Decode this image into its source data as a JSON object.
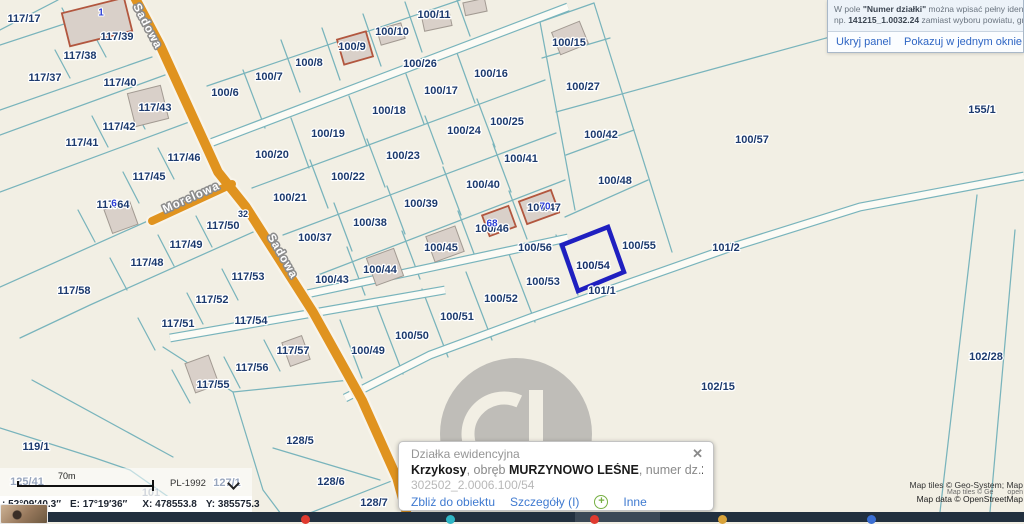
{
  "map": {
    "bg_color": "#f2efe4",
    "line_color": "#79b4bc",
    "road_color": "#e0931f",
    "label_color": "#1c3a6e",
    "highlight_color": "#1f1fc0",
    "parcel_labels": [
      {
        "t": "117/17",
        "x": 24,
        "y": 18
      },
      {
        "t": "117/39",
        "x": 117,
        "y": 36
      },
      {
        "t": "117/38",
        "x": 80,
        "y": 55
      },
      {
        "t": "117/37",
        "x": 45,
        "y": 77
      },
      {
        "t": "117/40",
        "x": 120,
        "y": 82
      },
      {
        "t": "117/43",
        "x": 155,
        "y": 107
      },
      {
        "t": "117/42",
        "x": 119,
        "y": 126
      },
      {
        "t": "117/41",
        "x": 82,
        "y": 142
      },
      {
        "t": "117/46",
        "x": 184,
        "y": 157
      },
      {
        "t": "117/45",
        "x": 149,
        "y": 176
      },
      {
        "t": "117/64",
        "x": 113,
        "y": 204
      },
      {
        "t": "117/50",
        "x": 223,
        "y": 225
      },
      {
        "t": "117/49",
        "x": 186,
        "y": 244
      },
      {
        "t": "117/48",
        "x": 147,
        "y": 262
      },
      {
        "t": "117/58",
        "x": 74,
        "y": 290
      },
      {
        "t": "117/53",
        "x": 248,
        "y": 276
      },
      {
        "t": "117/52",
        "x": 212,
        "y": 299
      },
      {
        "t": "117/51",
        "x": 178,
        "y": 323
      },
      {
        "t": "117/54",
        "x": 251,
        "y": 320
      },
      {
        "t": "117/57",
        "x": 293,
        "y": 350
      },
      {
        "t": "117/56",
        "x": 252,
        "y": 367
      },
      {
        "t": "117/55",
        "x": 213,
        "y": 384
      },
      {
        "t": "100/6",
        "x": 225,
        "y": 92
      },
      {
        "t": "100/7",
        "x": 269,
        "y": 76
      },
      {
        "t": "100/8",
        "x": 309,
        "y": 62
      },
      {
        "t": "100/9",
        "x": 352,
        "y": 46
      },
      {
        "t": "100/10",
        "x": 392,
        "y": 31
      },
      {
        "t": "100/11",
        "x": 434,
        "y": 14
      },
      {
        "t": "100/26",
        "x": 420,
        "y": 63
      },
      {
        "t": "100/15",
        "x": 569,
        "y": 42
      },
      {
        "t": "100/16",
        "x": 491,
        "y": 73
      },
      {
        "t": "100/17",
        "x": 441,
        "y": 90
      },
      {
        "t": "100/18",
        "x": 389,
        "y": 110
      },
      {
        "t": "100/19",
        "x": 328,
        "y": 133
      },
      {
        "t": "100/20",
        "x": 272,
        "y": 154
      },
      {
        "t": "100/27",
        "x": 583,
        "y": 86
      },
      {
        "t": "100/25",
        "x": 507,
        "y": 121
      },
      {
        "t": "100/24",
        "x": 464,
        "y": 130
      },
      {
        "t": "100/23",
        "x": 403,
        "y": 155
      },
      {
        "t": "100/22",
        "x": 348,
        "y": 176
      },
      {
        "t": "100/21",
        "x": 290,
        "y": 197
      },
      {
        "t": "100/42",
        "x": 601,
        "y": 134
      },
      {
        "t": "100/41",
        "x": 521,
        "y": 158
      },
      {
        "t": "100/40",
        "x": 483,
        "y": 184
      },
      {
        "t": "100/39",
        "x": 421,
        "y": 203
      },
      {
        "t": "100/38",
        "x": 370,
        "y": 222
      },
      {
        "t": "100/37",
        "x": 315,
        "y": 237
      },
      {
        "t": "100/48",
        "x": 615,
        "y": 180
      },
      {
        "t": "100/47",
        "x": 544,
        "y": 207
      },
      {
        "t": "100/46",
        "x": 492,
        "y": 228
      },
      {
        "t": "100/45",
        "x": 441,
        "y": 247
      },
      {
        "t": "100/44",
        "x": 380,
        "y": 269
      },
      {
        "t": "100/43",
        "x": 332,
        "y": 279
      },
      {
        "t": "100/57",
        "x": 752,
        "y": 139
      },
      {
        "t": "100/56",
        "x": 535,
        "y": 247
      },
      {
        "t": "100/55",
        "x": 639,
        "y": 245
      },
      {
        "t": "100/53",
        "x": 543,
        "y": 281
      },
      {
        "t": "100/52",
        "x": 501,
        "y": 298
      },
      {
        "t": "100/51",
        "x": 457,
        "y": 316
      },
      {
        "t": "100/50",
        "x": 412,
        "y": 335
      },
      {
        "t": "100/49",
        "x": 368,
        "y": 350
      },
      {
        "t": "101/2",
        "x": 726,
        "y": 247
      },
      {
        "t": "101/1",
        "x": 602,
        "y": 290
      },
      {
        "t": "155/1",
        "x": 982,
        "y": 109
      },
      {
        "t": "102/28",
        "x": 986,
        "y": 356
      },
      {
        "t": "102/15",
        "x": 718,
        "y": 386
      },
      {
        "t": "128/5",
        "x": 300,
        "y": 440
      },
      {
        "t": "128/6",
        "x": 331,
        "y": 481
      },
      {
        "t": "128/7",
        "x": 374,
        "y": 502
      },
      {
        "t": "127/1",
        "x": 227,
        "y": 482
      },
      {
        "t": "125/41",
        "x": 27,
        "y": 481
      },
      {
        "t": "119/1",
        "x": 36,
        "y": 446
      },
      {
        "t": "32",
        "x": 243,
        "y": 214,
        "cls": "small"
      },
      {
        "t": "101",
        "x": 151,
        "y": 492,
        "cls": "pale"
      }
    ],
    "street_labels": [
      {
        "t": "Sadowa",
        "x": 148,
        "y": 26,
        "r": 62
      },
      {
        "t": "Sadowa",
        "x": 283,
        "y": 256,
        "r": 60
      },
      {
        "t": "Morelowa",
        "x": 191,
        "y": 197,
        "r": -24
      }
    ],
    "address_labels": [
      {
        "t": "1",
        "x": 101,
        "y": 12
      },
      {
        "t": "6",
        "x": 114,
        "y": 203
      },
      {
        "t": "68",
        "x": 492,
        "y": 223
      },
      {
        "t": "70",
        "x": 545,
        "y": 206
      }
    ],
    "highlight": {
      "label": "100/54",
      "x": 593,
      "y": 265
    }
  },
  "help_panel": {
    "line1_pre": "W pole ",
    "line1_bold": "\"Numer działki\"",
    "line1_post": " można wpisać pełny ident",
    "line2_pre": "np. ",
    "line2_bold": "141215_1.0032.24",
    "line2_post": " zamiast wyboru powiatu, gr",
    "link_hide": "Ukryj panel",
    "link_single_window": "Pokazuj w jednym oknie"
  },
  "scale": {
    "distance": "70m",
    "crs": "PL-1992"
  },
  "coords": {
    "lat": ": 52°09′40.3″",
    "lon": "E: 17°19′36″",
    "x": "X: 478553.8",
    "y": "Y: 385575.3"
  },
  "attribution": {
    "line1": "Map tiles © Geo-System; Map",
    "ghost1": "Map tiles © Ge",
    "ghost2": "open",
    "line2": "Map data © OpenStreetMap"
  },
  "popup": {
    "title": "Działka ewidencyjna",
    "close": "✕",
    "name_bold": "Krzykosy",
    "sep1": ", obręb ",
    "area_bold": "MURZYNOWO LEŚNE",
    "sep2": ", numer dz.",
    "parcel_bold": "100/54",
    "id_line": "302502_2.0006.100/54",
    "link_zoom": "Zbliż do obiektu",
    "link_details": "Szczegóły (I)",
    "plus": "+",
    "link_other": "Inne"
  }
}
